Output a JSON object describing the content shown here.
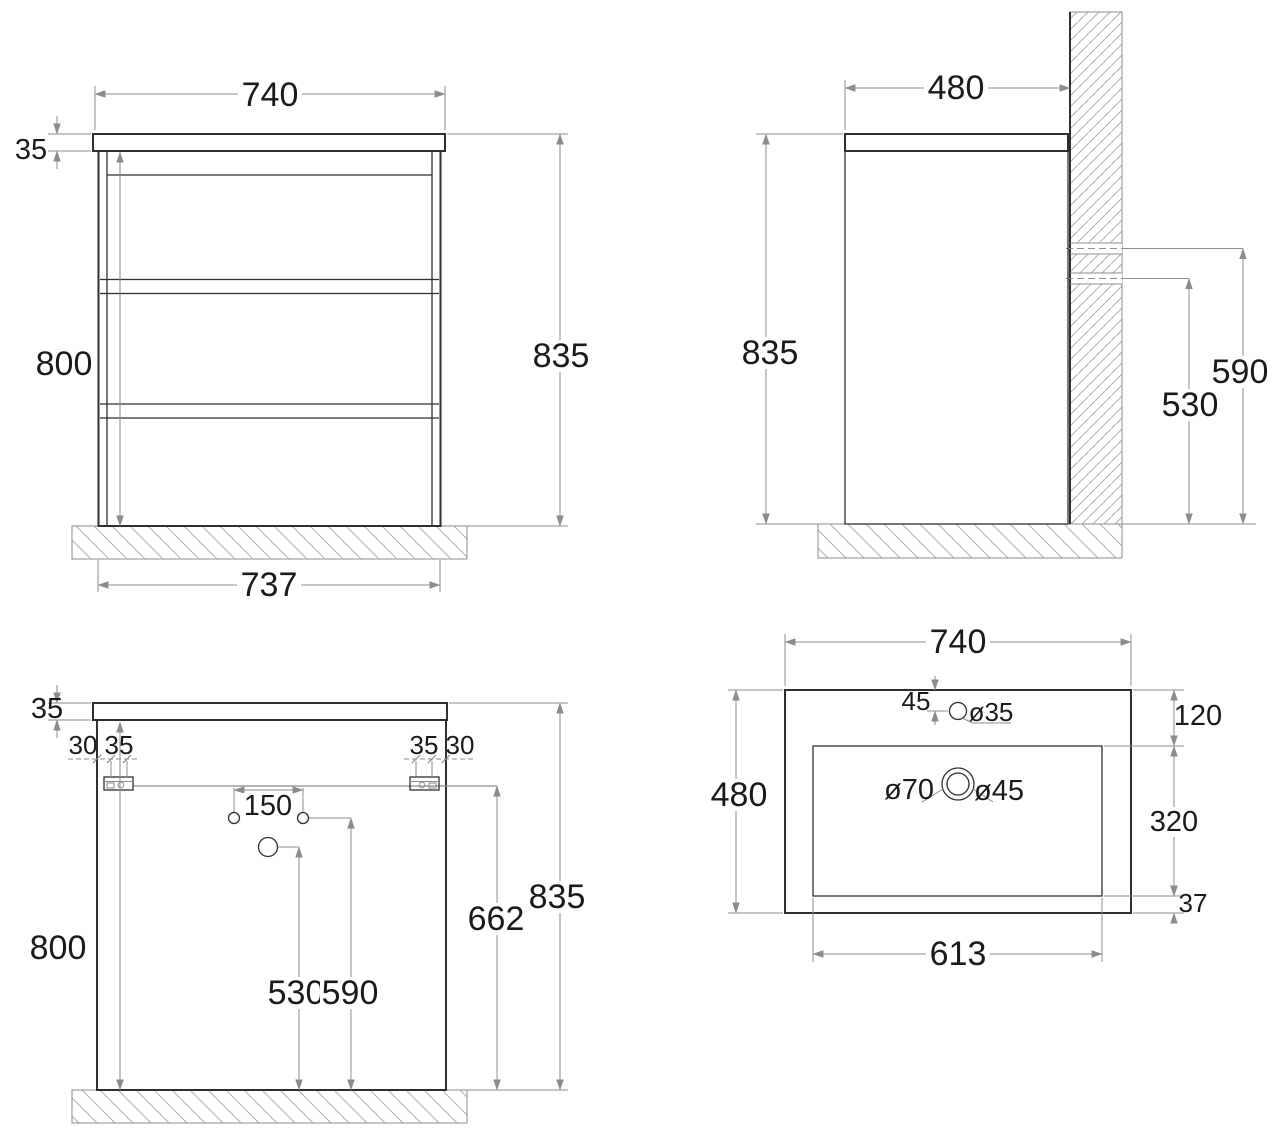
{
  "drawing_type": "vanity-cabinet-technical-drawing",
  "colors": {
    "line": "#2f2f2f",
    "dim": "#8c8c8c",
    "text": "#1a1a1a",
    "hatch": "#b2b2b2",
    "bg": "#ffffff"
  },
  "front": {
    "w_top": "740",
    "t_top": "35",
    "h_body": "800",
    "h_total": "835",
    "w_bottom": "737"
  },
  "side": {
    "depth": "480",
    "h_total": "835",
    "h_pipe_upper": "590",
    "h_pipe_lower": "530"
  },
  "back": {
    "t_top": "35",
    "off_outer_l": "30",
    "off_inner_l": "35",
    "off_inner_r": "35",
    "off_outer_r": "30",
    "hole_spacing": "150",
    "h_body": "800",
    "h_bracket": "662",
    "h_total": "835",
    "h_siphon": "530",
    "h_faucet": "590"
  },
  "sink": {
    "w": "740",
    "d": "480",
    "faucet_off": "45",
    "faucet_d": "ø35",
    "rim_top": "120",
    "drain_outer": "ø70",
    "drain_inner": "ø45",
    "basin_d": "320",
    "rim_bottom": "37",
    "basin_w": "613"
  }
}
